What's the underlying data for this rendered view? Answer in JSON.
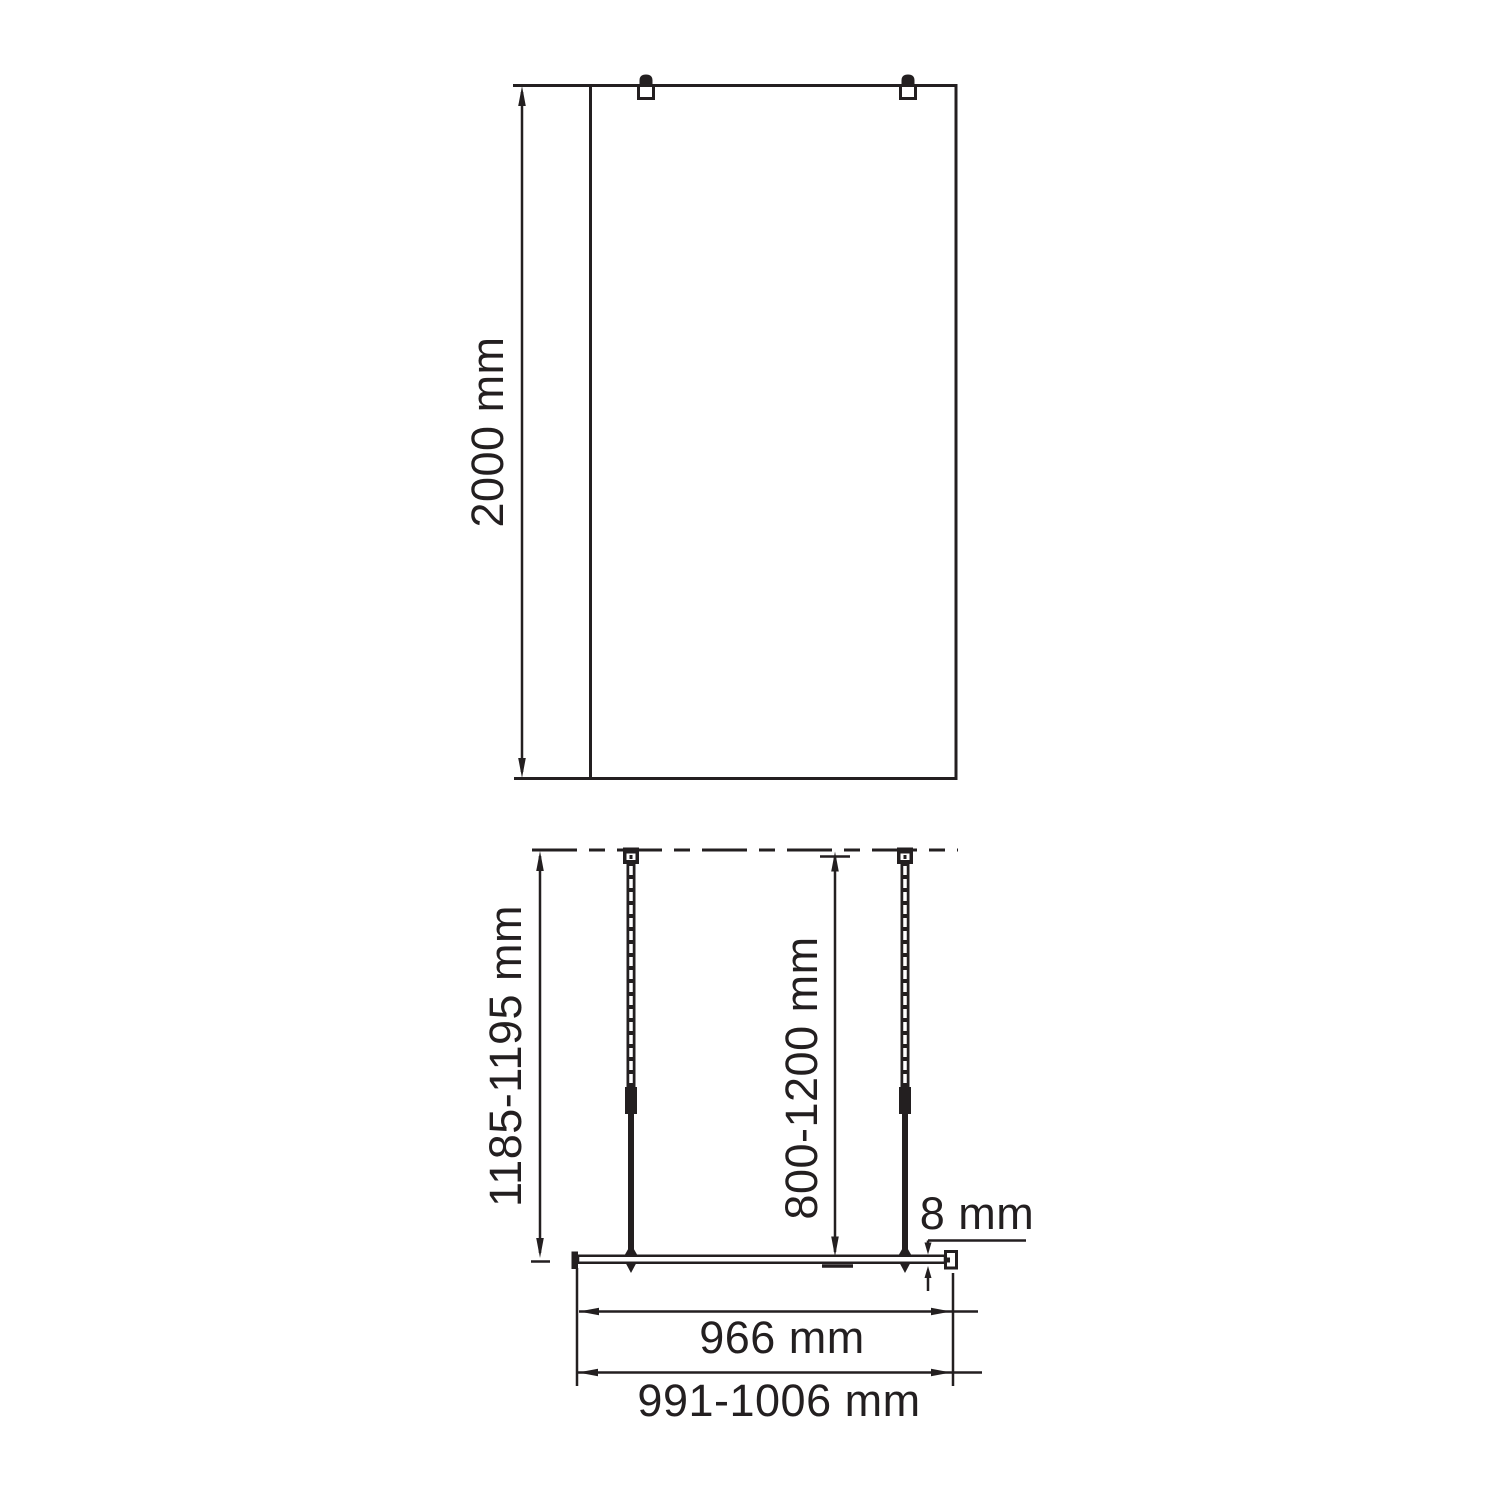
{
  "ink_color": "#231f20",
  "front_view": {
    "height_label": "2000 mm"
  },
  "plan_view": {
    "support_bar_length_label": "1185-1195 mm",
    "bar_adjust_range_label": "800-1200 mm",
    "glass_thickness_label": "8 mm",
    "glass_width_label": "966 mm",
    "overall_width_label": "991-1006 mm"
  }
}
